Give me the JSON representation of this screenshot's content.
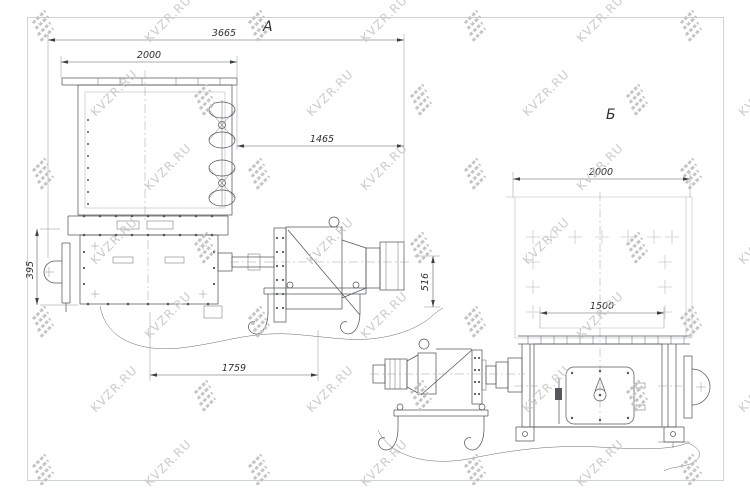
{
  "drawing": {
    "frame_color": "#cfd3d7",
    "line_dark": "#53585d",
    "line_light": "#c7ccd1",
    "text_color": "#2f2f2f",
    "views": {
      "a": {
        "label": "А",
        "dims": {
          "overall_length": "3665",
          "body_width": "2000",
          "drive_length": "1465",
          "left_bracket_height": "395",
          "drive_height": "516",
          "base_length": "1759"
        }
      },
      "b": {
        "label": "Б",
        "dims": {
          "overall_width": "2000",
          "base_width": "1500"
        }
      }
    }
  },
  "watermark": {
    "text": "KVZR.RU",
    "color": "#c6c6c6",
    "icon_color": "#c4c4c4"
  }
}
